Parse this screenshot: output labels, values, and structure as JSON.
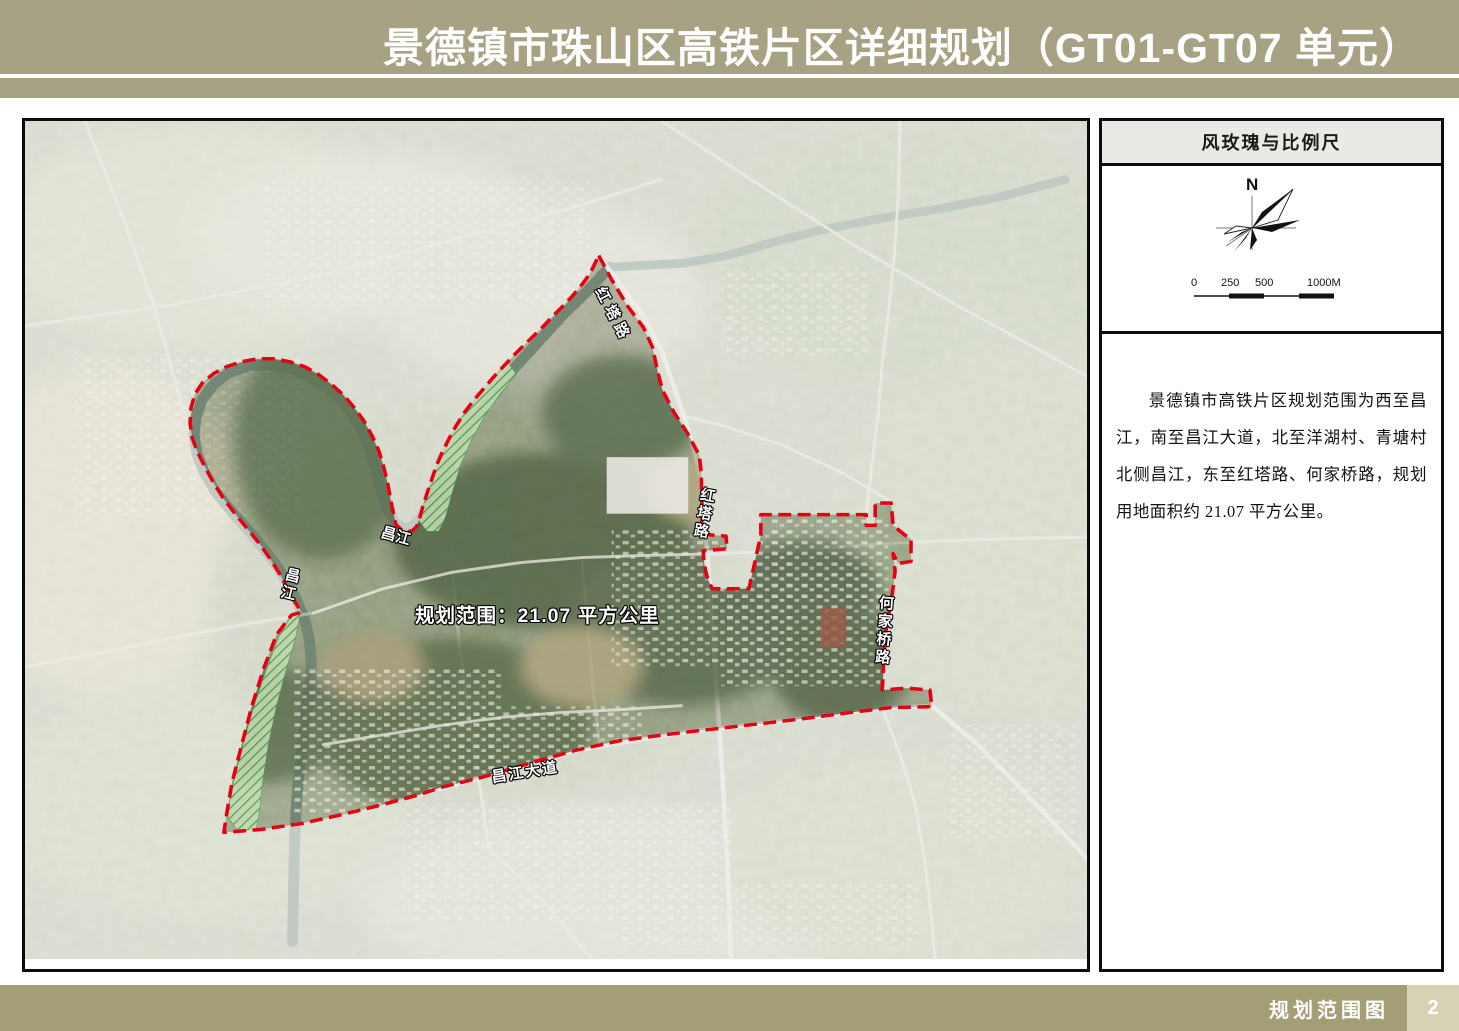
{
  "header": {
    "title": "景德镇市珠山区高铁片区详细规划（GT01-GT07 单元）"
  },
  "legend": {
    "title": "风玫瑰与比例尺",
    "compass_north": "N",
    "scale_ticks": [
      "0",
      "250",
      "500",
      "1000M"
    ],
    "description": "景德镇市高铁片区规划范围为西至昌江，南至昌江大道，北至洋湖村、青塘村北侧昌江，东至红塔路、何家桥路，规划用地面积约 21.07 平方公里。"
  },
  "map": {
    "area_label": "规划范围：21.07 平方公里",
    "labels": {
      "hongta_road_upper": "红塔路",
      "hongta_road_lower": "红塔路",
      "changjiang_east": "昌江",
      "changjiang_west": "昌江",
      "hejiaqiao_road": "何家桥路",
      "changjiang_avenue": "昌江大道"
    }
  },
  "footer": {
    "caption": "规划范围图",
    "page": "2"
  },
  "colors": {
    "band_khaki": "#a7a284",
    "footer_khaki": "#a49e77",
    "page_box_khaki": "#d6d2b6",
    "legend_header_bg": "#e9e9e6",
    "boundary_red": "#e60014"
  }
}
